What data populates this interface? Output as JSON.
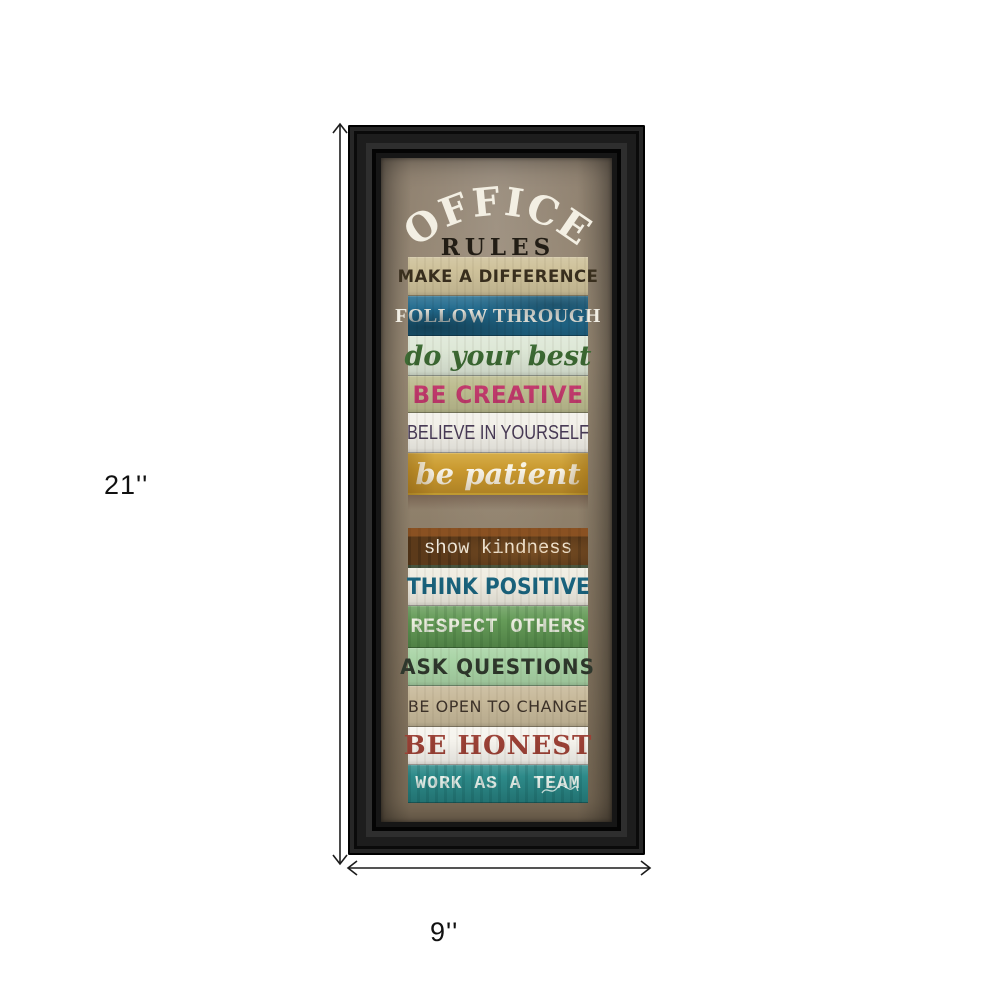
{
  "product": {
    "height_label": "21''",
    "width_label": "9''"
  },
  "artwork": {
    "title": "OFFICE",
    "subtitle": "RULES",
    "planks": [
      {
        "text": "MAKE A DIFFERENCE",
        "bg": "#cfc29b",
        "fg": "#392f1e"
      },
      {
        "text": "FOLLOW THROUGH",
        "bg": "#226b8e",
        "fg": "#f1eee4"
      },
      {
        "text": "do your best",
        "bg": "#dee8d7",
        "fg": "#3c6a33"
      },
      {
        "text": "BE CREATIVE",
        "bg": "#bdbd90",
        "fg": "#c23a6d"
      },
      {
        "text": "BELIEVE IN YOURSELF",
        "bg": "#f2f0e9",
        "fg": "#483a57"
      },
      {
        "text": "be patient",
        "bg": "#c9992f",
        "fg": "#f8f4e9"
      },
      {
        "text": "show kindness",
        "bg": "#5c3a1a",
        "fg": "#f2ecdf"
      },
      {
        "text": "THINK POSITIVE",
        "bg": "#efece1",
        "fg": "#19647f"
      },
      {
        "text": "RESPECT OTHERS",
        "bg": "#659b58",
        "fg": "#edefe1"
      },
      {
        "text": "ASK QUESTIONS",
        "bg": "#a9d4a6",
        "fg": "#2e372c"
      },
      {
        "text": "BE OPEN TO CHANGE",
        "bg": "#c8ba9b",
        "fg": "#3e332a"
      },
      {
        "text": "BE HONEST",
        "bg": "#f6f4ee",
        "fg": "#9c4136"
      },
      {
        "text": "WORK AS A TEAM",
        "bg": "#2d8a89",
        "fg": "#e9f1eb"
      }
    ],
    "colors": {
      "frame": "#161616",
      "art-bg": "#8b7d6a",
      "title": "#f3efe3",
      "subtitle": "#221d15",
      "dimension": "#1c1c1c",
      "label": "#111111"
    }
  }
}
